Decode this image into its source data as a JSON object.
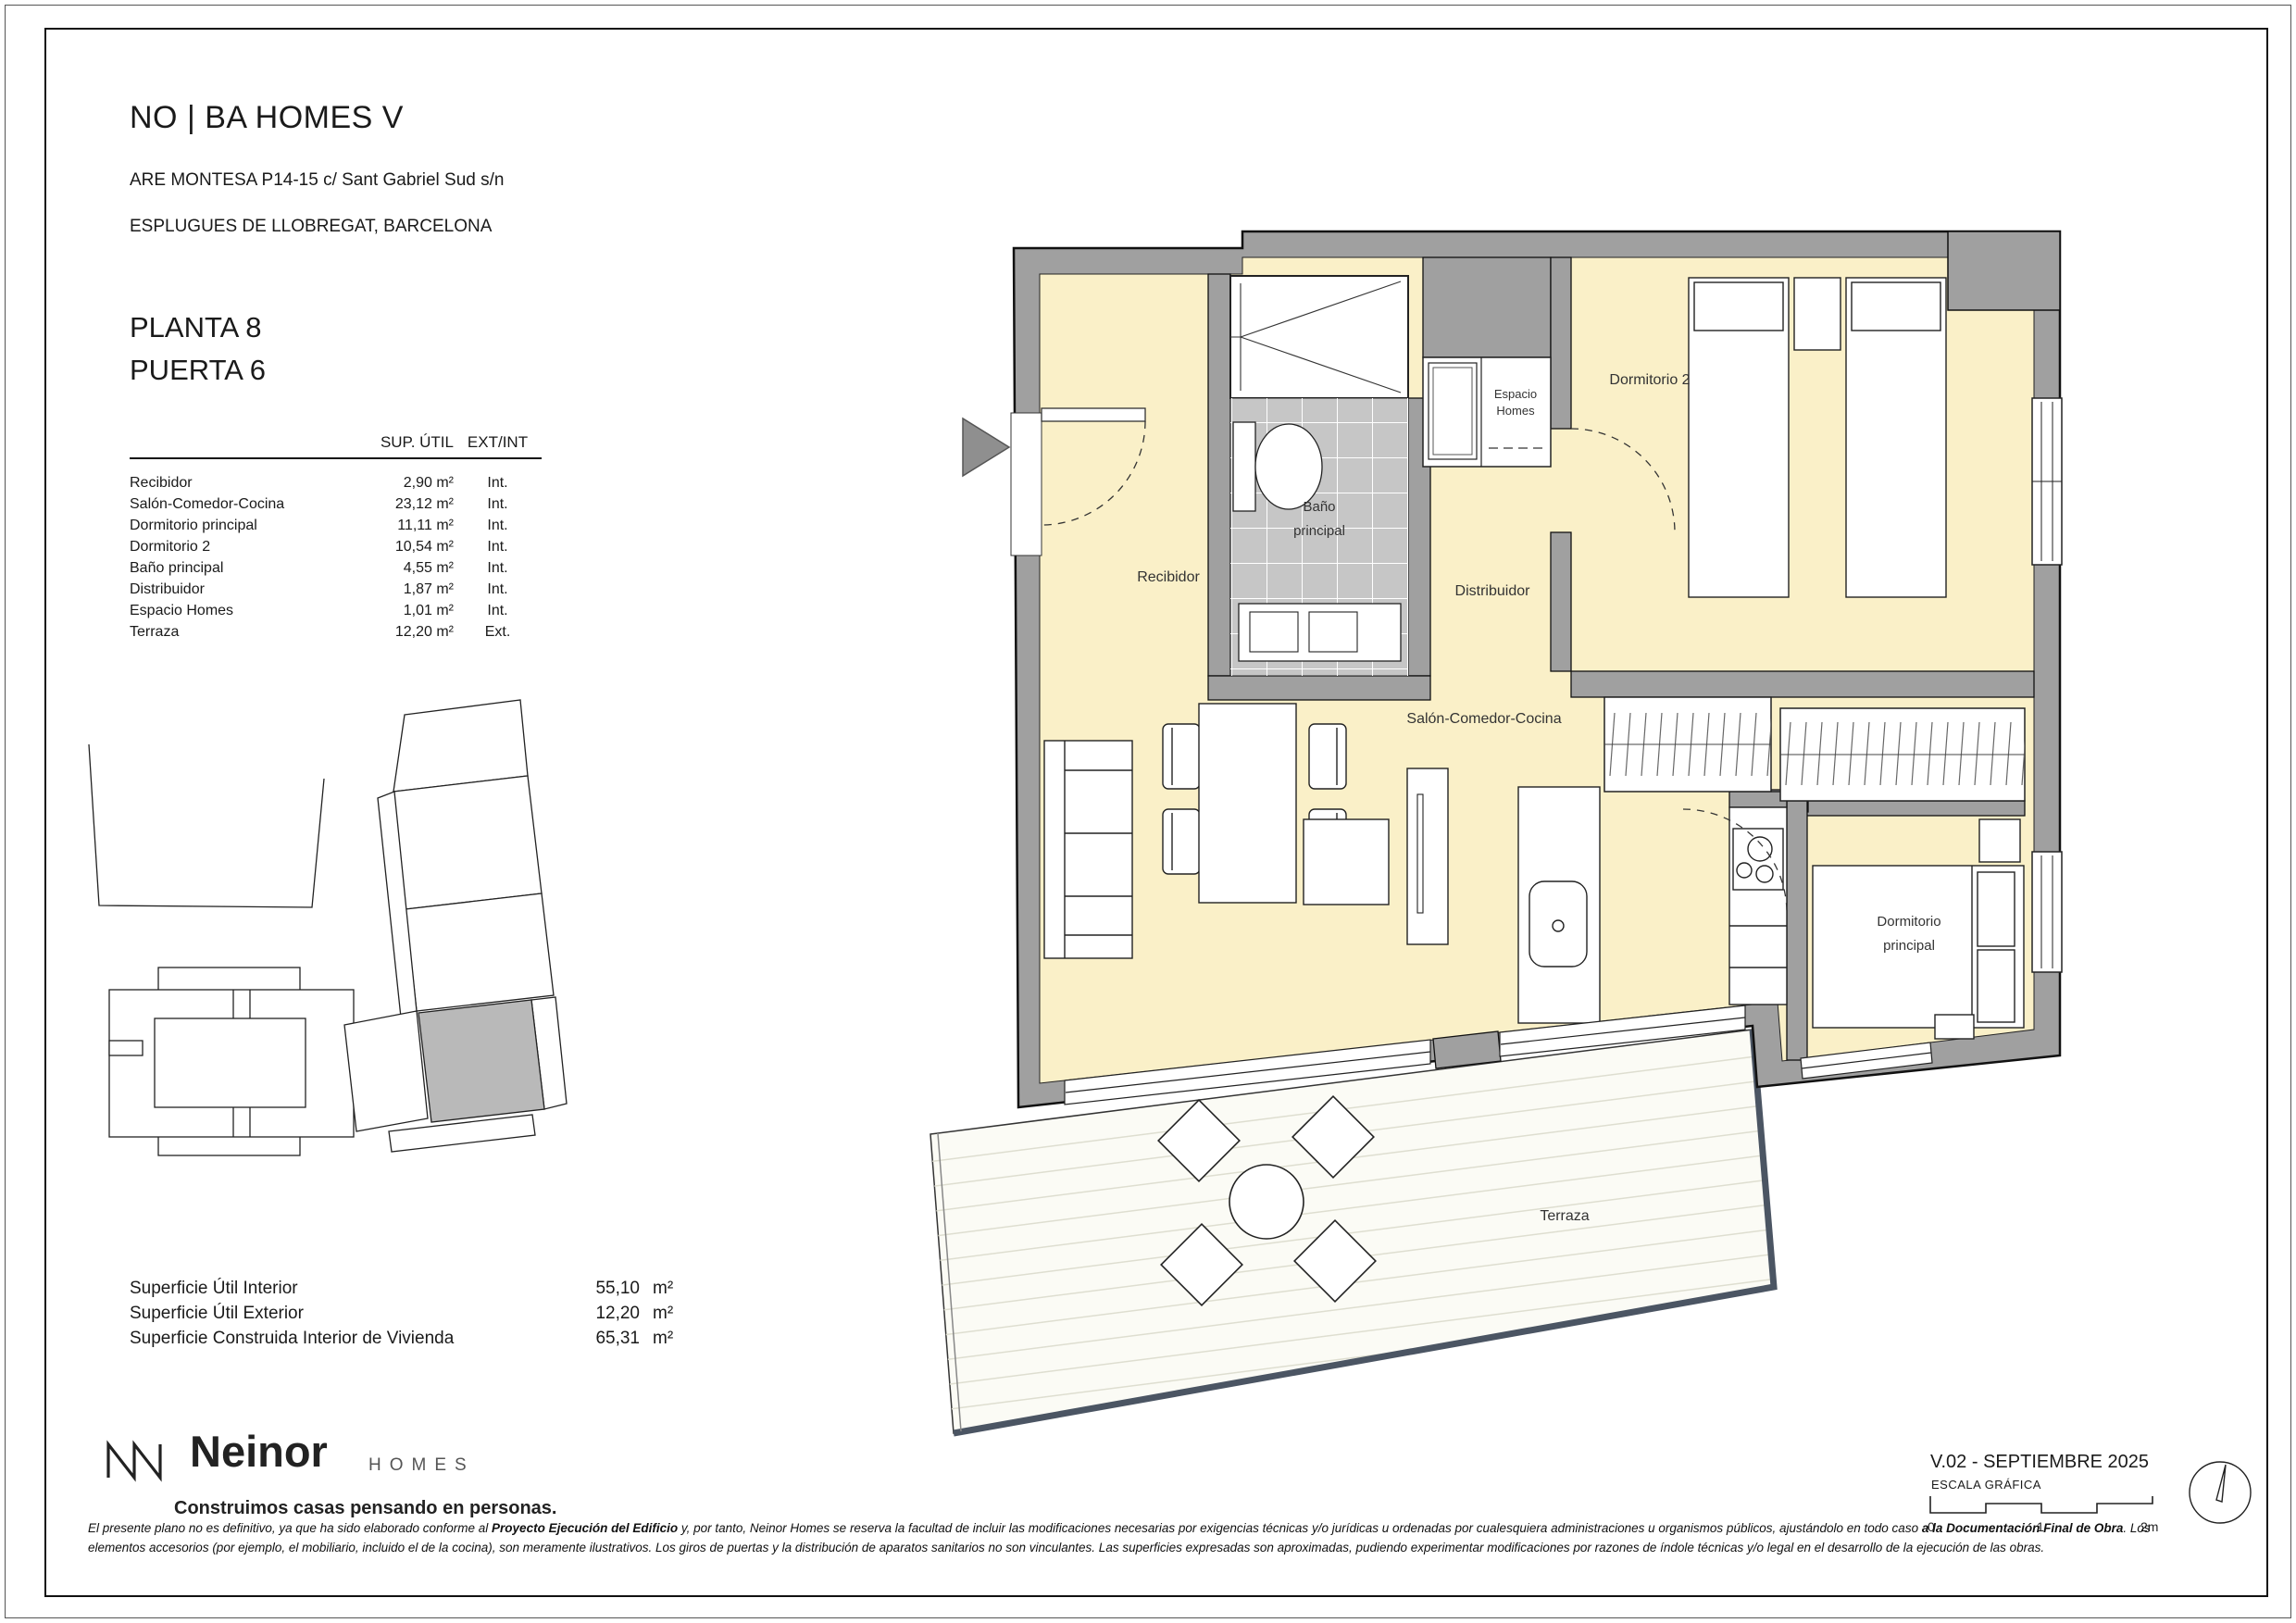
{
  "header": {
    "title": "NO | BA HOMES V",
    "address_line1": "ARE MONTESA P14-15 c/ Sant Gabriel Sud s/n",
    "address_line2": "ESPLUGUES DE LLOBREGAT, BARCELONA",
    "floor": "PLANTA 8",
    "door": "PUERTA 6"
  },
  "areas_table": {
    "col_sup": "SUP. ÚTIL",
    "col_ext": "EXT/INT",
    "rows": [
      {
        "room": "Recibidor",
        "area": "2,90 m²",
        "type": "Int."
      },
      {
        "room": "Salón-Comedor-Cocina",
        "area": "23,12 m²",
        "type": "Int."
      },
      {
        "room": "Dormitorio principal",
        "area": "11,11 m²",
        "type": "Int."
      },
      {
        "room": "Dormitorio 2",
        "area": "10,54 m²",
        "type": "Int."
      },
      {
        "room": "Baño principal",
        "area": "4,55 m²",
        "type": "Int."
      },
      {
        "room": "Distribuidor",
        "area": "1,87 m²",
        "type": "Int."
      },
      {
        "room": "Espacio Homes",
        "area": "1,01 m²",
        "type": "Int."
      },
      {
        "room": "Terraza",
        "area": "12,20 m²",
        "type": "Ext."
      }
    ]
  },
  "summary": {
    "rows": [
      {
        "label": "Superficie Útil Interior",
        "value": "55,10",
        "unit": "m²"
      },
      {
        "label": "Superficie Útil Exterior",
        "value": "12,20",
        "unit": "m²"
      },
      {
        "label": "Superficie Construida Interior de Vivienda",
        "value": "65,31",
        "unit": "m²"
      }
    ]
  },
  "plan": {
    "labels": {
      "recibidor": "Recibidor",
      "bano_1": "Baño",
      "bano_2": "principal",
      "espacio_1": "Espacio",
      "espacio_2": "Homes",
      "dormitorio2": "Dormitorio 2",
      "distribuidor": "Distribuidor",
      "salon": "Salón-Comedor-Cocina",
      "dormppal_1": "Dormitorio",
      "dormppal_2": "principal",
      "terraza": "Terraza"
    },
    "colors": {
      "floor": "#faf0c8",
      "wall": "#a0a0a0",
      "tile": "#c6c6c6",
      "deck": "#fbfbf5",
      "highlight_unit": "#b9b9b9"
    }
  },
  "logo": {
    "brand": "Neinor",
    "sub": "HOMES",
    "tagline": "Construimos casas pensando en personas."
  },
  "footer": {
    "version": "V.02 - SEPTIEMBRE 2025",
    "scale_label": "ESCALA GRÁFICA",
    "scale_ticks": [
      "0",
      "1",
      "2m"
    ],
    "disclaimer_segments": [
      {
        "text": "El presente plano no es definitivo, ya que ha sido elaborado conforme al ",
        "bold": false
      },
      {
        "text": "Proyecto Ejecución del Edificio",
        "bold": true
      },
      {
        "text": " y, por tanto, Neinor Homes se reserva la facultad de incluir las modificaciones necesarias por exigencias técnicas y/o jurídicas u ordenadas por cualesquiera administraciones u organismos públicos, ajustándolo en todo caso ",
        "bold": false
      },
      {
        "text": "a la Documentación Final de Obra",
        "bold": true
      },
      {
        "text": ". Los elementos accesorios (por ejemplo, el mobiliario, incluido el de la cocina), son meramente ilustrativos. Los giros de puertas y la distribución de aparatos sanitarios no son vinculantes. Las superficies expresadas son aproximadas, pudiendo experimentar modificaciones por razones de índole técnicas y/o legal en el desarrollo de la ejecución de las obras.",
        "bold": false
      }
    ]
  }
}
